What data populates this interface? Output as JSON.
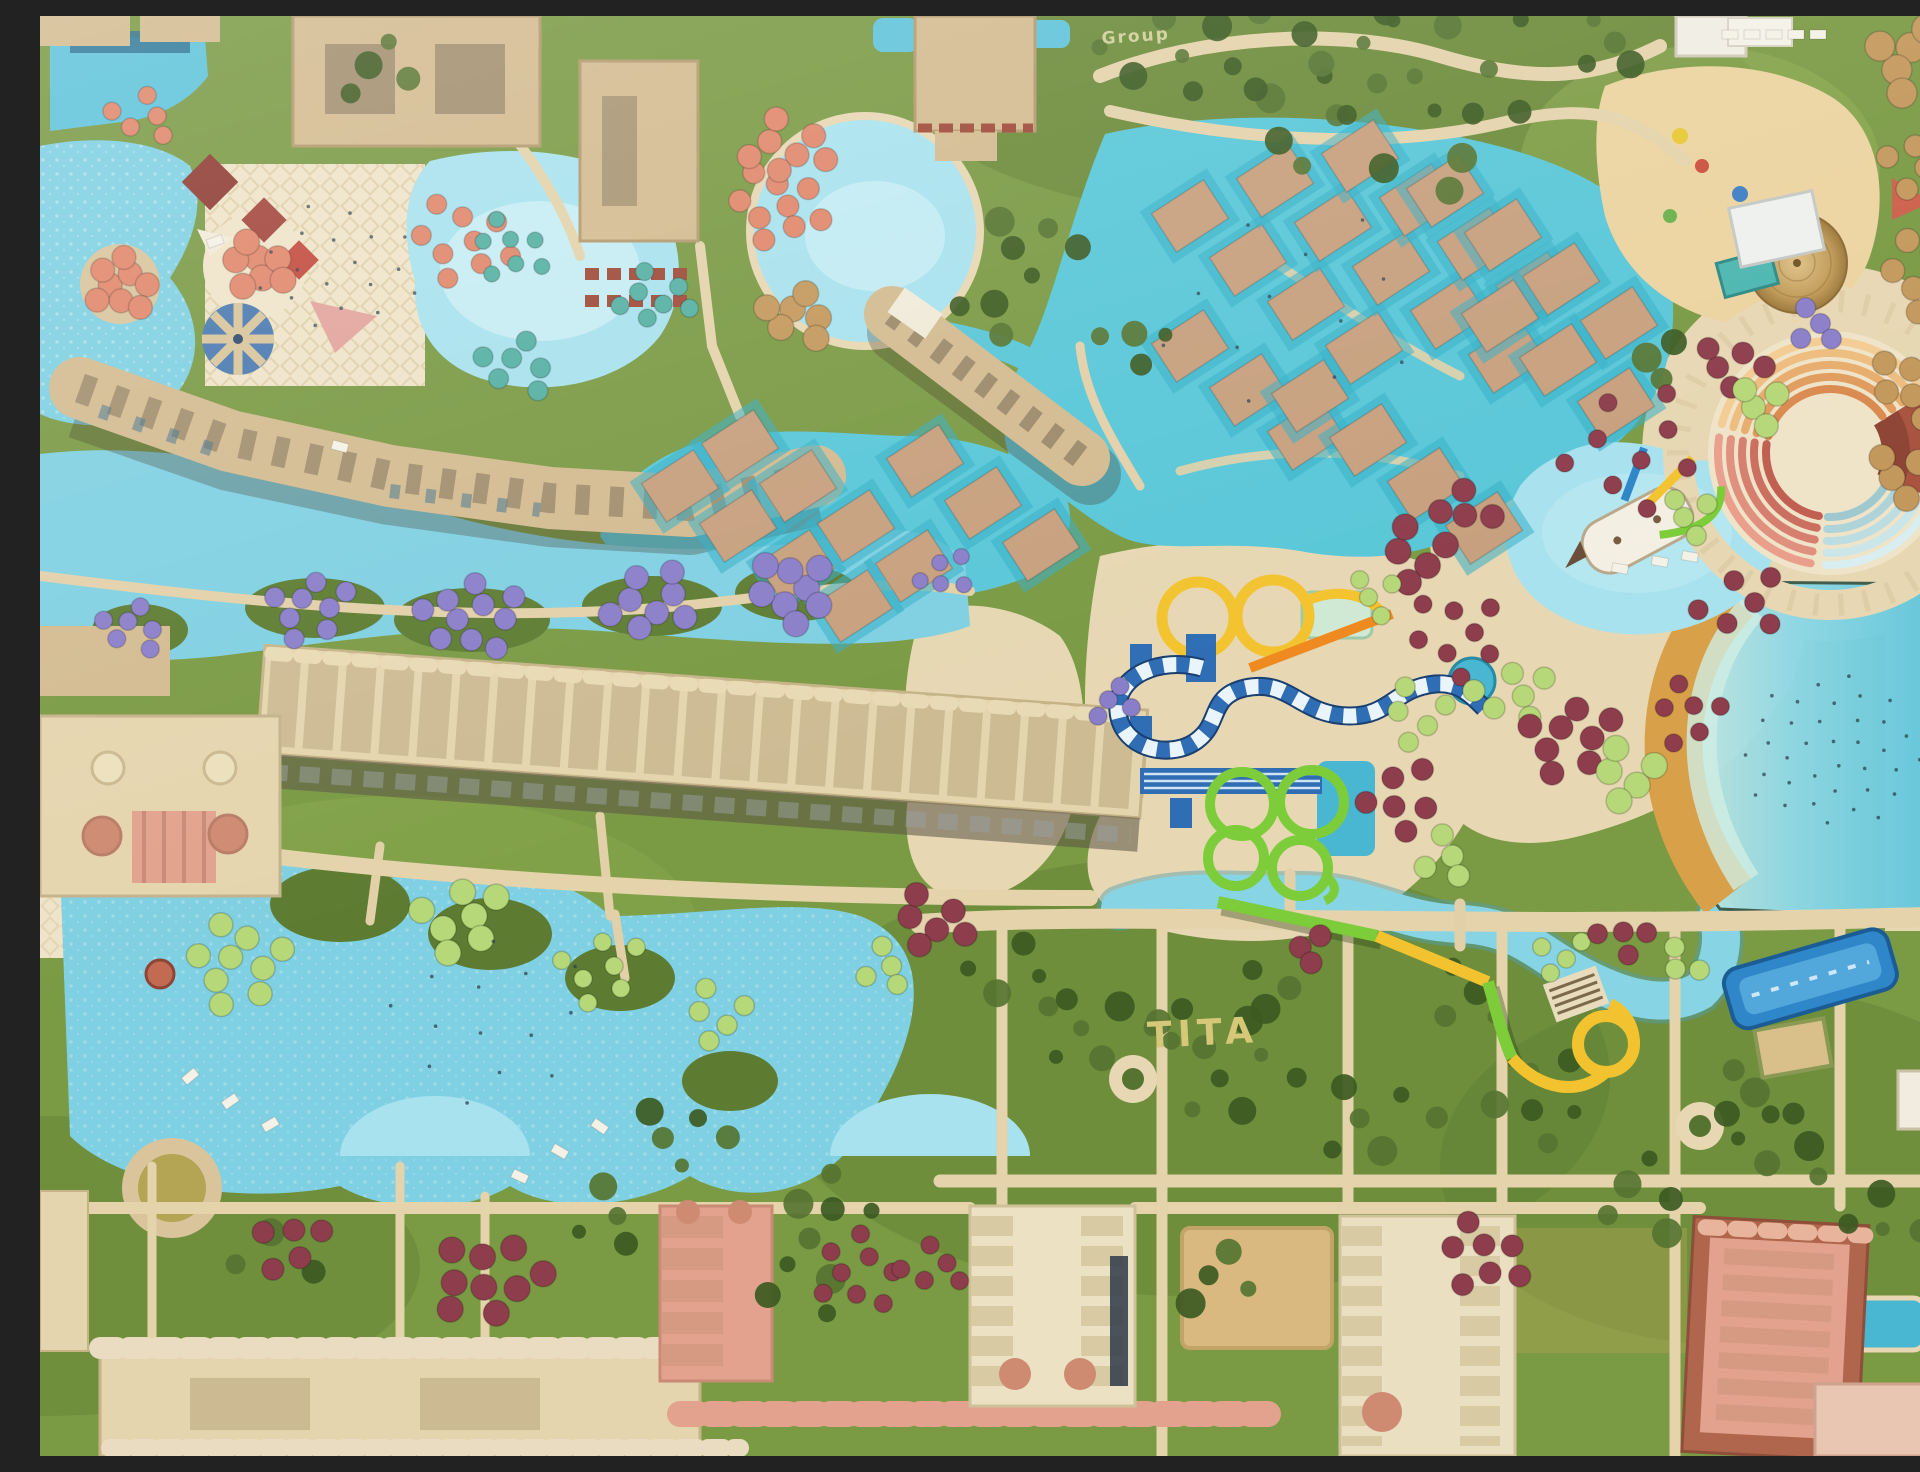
{
  "scene": {
    "type": "aerial-drone-photo",
    "subject": "waterpark resort complex with pools, water slides, gardens and hotel buildings",
    "plant_text_main": "TITA",
    "plant_text_secondary": "Group"
  },
  "palette": {
    "grass": "#7a9a44",
    "grassDark": "#5d7c31",
    "grassLight": "#8fae51",
    "foliage": "#3c5a22",
    "foliageLight": "#567431",
    "deck": "#e7d7b3",
    "deckLight": "#efe4c8",
    "deckShade": "#d9c49c",
    "path": "#e4d3ab",
    "waterLight": "#a8e2ee",
    "water": "#7fd0e2",
    "waterMid": "#5fc3da",
    "waterDeep": "#49b7d2",
    "waterTeal": "#59c7d8",
    "waterPale": "#c2ecf2",
    "roofTan": "#d3bb90",
    "roofTanDark": "#c4a97c",
    "roofCream": "#e5d5ae",
    "roofSalmon": "#e2a28d",
    "roofSalmonDeep": "#cf8a72",
    "roofBrown": "#b0664c",
    "roofWhite": "#f0ead8",
    "roofMaroon": "#8e3b33",
    "windowDark": "#4a4033",
    "shadow": "rgba(60,50,30,0.3)",
    "sand": "#d8a049",
    "sandLight": "#ecd4a0",
    "sandOlive": "#b3a553",
    "cabanaRoof": "#c7a07e",
    "cabanaPad": "#35aec6",
    "umbPurple": "#8a7ec9",
    "umbMaroon": "#8e3d4c",
    "umbLime": "#b6d878",
    "umbTeal": "#55b0a2",
    "umbCoral": "#e0876a",
    "umbStraw": "#c3985c",
    "slideYellow": "#f3c32f",
    "slideOrange": "#ee8a1f",
    "slideBlue": "#2f6db5",
    "slideBlueDark": "#1a3f70",
    "slideGreen": "#7ccd39",
    "slideSky": "#2f86c8",
    "stage": "#a85441",
    "stageInner": "#8e4536",
    "plantText": "#d6c878",
    "plantTextSmall": "#cfcf9a",
    "speck": "#2f4250"
  },
  "amphitheater": {
    "cx": 1790,
    "cy": 437,
    "walk_r": 152,
    "walk_w": 30,
    "plaza_r": 52,
    "radii": [
      64,
      76,
      88,
      100,
      112
    ],
    "sectors": [
      {
        "from": 195,
        "to": 325,
        "ramp": "warm"
      },
      {
        "from": 100,
        "to": 188,
        "ramp": "red"
      },
      {
        "from": 30,
        "to": 92,
        "ramp": "cool"
      }
    ],
    "ramps": {
      "warm": [
        "#d98a4f",
        "#e09c5d",
        "#e7ad6c",
        "#eebd7e",
        "#f3cc92"
      ],
      "red": [
        "#c05f52",
        "#cb6f60",
        "#d67f6f",
        "#e0907e",
        "#ea9f8d"
      ],
      "cool": [
        "#9fc8cf",
        "#aed3d8",
        "#bcdde1",
        "#cae6e9",
        "#d8eef0"
      ]
    },
    "stage_wedge": {
      "from": -32,
      "to": 24,
      "r1": 42,
      "r2": 128
    }
  },
  "cabana_style": {
    "w": 62,
    "h": 46,
    "angle": -33
  },
  "cabana_chains": [
    {
      "x": 1150,
      "y": 200,
      "dx": 58,
      "dy": 44,
      "count": 4
    },
    {
      "x": 1235,
      "y": 165,
      "dx": 58,
      "dy": 44,
      "count": 5
    },
    {
      "x": 1320,
      "y": 140,
      "dx": 58,
      "dy": 44,
      "count": 4
    },
    {
      "x": 1405,
      "y": 175,
      "dx": 58,
      "dy": 44,
      "count": 4
    },
    {
      "x": 1150,
      "y": 330,
      "dx": 58,
      "dy": 44,
      "count": 3
    },
    {
      "x": 1460,
      "y": 300,
      "dx": 58,
      "dy": 44,
      "count": 3
    },
    {
      "x": 1270,
      "y": 380,
      "dx": 58,
      "dy": 44,
      "count": 4
    },
    {
      "x": 640,
      "y": 470,
      "dx": 58,
      "dy": 40,
      "count": 4
    },
    {
      "x": 700,
      "y": 430,
      "dx": 58,
      "dy": 40,
      "count": 4
    },
    {
      "x": 885,
      "y": 445,
      "dx": 58,
      "dy": 42,
      "count": 3
    }
  ],
  "umbrella_clusters": [
    {
      "x": 95,
      "y": 612,
      "count": 6,
      "spread": 34,
      "r": 11,
      "color": "umbPurple"
    },
    {
      "x": 270,
      "y": 590,
      "count": 8,
      "spread": 44,
      "r": 11,
      "color": "umbPurple"
    },
    {
      "x": 430,
      "y": 602,
      "count": 10,
      "spread": 52,
      "r": 11,
      "color": "umbPurple"
    },
    {
      "x": 610,
      "y": 588,
      "count": 8,
      "spread": 46,
      "r": 11,
      "color": "umbPurple"
    },
    {
      "x": 755,
      "y": 575,
      "count": 8,
      "spread": 44,
      "r": 11,
      "color": "umbPurple"
    },
    {
      "x": 905,
      "y": 560,
      "count": 5,
      "spread": 30,
      "r": 10,
      "color": "umbPurple"
    },
    {
      "x": 1075,
      "y": 690,
      "count": 4,
      "spread": 26,
      "r": 10,
      "color": "umbPurple"
    },
    {
      "x": 1770,
      "y": 310,
      "count": 4,
      "spread": 28,
      "r": 10,
      "color": "umbPurple"
    },
    {
      "x": 80,
      "y": 268,
      "count": 8,
      "spread": 36,
      "r": 11,
      "color": "umbCoral"
    },
    {
      "x": 215,
      "y": 250,
      "count": 7,
      "spread": 34,
      "r": 11,
      "color": "umbCoral"
    },
    {
      "x": 105,
      "y": 100,
      "count": 5,
      "spread": 35,
      "r": 11,
      "color": "umbCoral"
    },
    {
      "x": 420,
      "y": 225,
      "count": 9,
      "spread": 55,
      "r": 11,
      "color": "umbCoral"
    },
    {
      "x": 735,
      "y": 190,
      "count": 9,
      "spread": 50,
      "r": 11,
      "color": "umbCoral"
    },
    {
      "x": 750,
      "y": 130,
      "count": 7,
      "spread": 44,
      "r": 11,
      "color": "umbCoral"
    },
    {
      "x": 760,
      "y": 300,
      "count": 6,
      "spread": 36,
      "r": 11,
      "color": "umbStraw"
    },
    {
      "x": 467,
      "y": 233,
      "count": 7,
      "spread": 42,
      "r": 10,
      "color": "umbTeal"
    },
    {
      "x": 617,
      "y": 280,
      "count": 7,
      "spread": 40,
      "r": 10,
      "color": "umbTeal"
    },
    {
      "x": 480,
      "y": 350,
      "count": 6,
      "spread": 40,
      "r": 10,
      "color": "umbTeal"
    },
    {
      "x": 200,
      "y": 950,
      "count": 9,
      "spread": 55,
      "r": 11,
      "color": "umbLime"
    },
    {
      "x": 420,
      "y": 900,
      "count": 7,
      "spread": 48,
      "r": 11,
      "color": "umbLime"
    },
    {
      "x": 560,
      "y": 950,
      "count": 7,
      "spread": 48,
      "r": 11,
      "color": "umbLime"
    },
    {
      "x": 680,
      "y": 1000,
      "count": 5,
      "spread": 38,
      "r": 11,
      "color": "umbLime"
    },
    {
      "x": 840,
      "y": 950,
      "count": 4,
      "spread": 30,
      "r": 10,
      "color": "umbLime"
    },
    {
      "x": 890,
      "y": 905,
      "count": 6,
      "spread": 40,
      "r": 11,
      "color": "umbMaroon"
    },
    {
      "x": 1380,
      "y": 540,
      "count": 5,
      "spread": 40,
      "r": 11,
      "color": "umbMaroon"
    },
    {
      "x": 1420,
      "y": 620,
      "count": 8,
      "spread": 55,
      "r": 11,
      "color": "umbMaroon"
    },
    {
      "x": 1340,
      "y": 580,
      "count": 4,
      "spread": 30,
      "r": 10,
      "color": "umbLime"
    },
    {
      "x": 1470,
      "y": 680,
      "count": 6,
      "spread": 42,
      "r": 11,
      "color": "umbLime"
    },
    {
      "x": 1530,
      "y": 720,
      "count": 8,
      "spread": 50,
      "r": 11,
      "color": "umbMaroon"
    },
    {
      "x": 1590,
      "y": 760,
      "count": 5,
      "spread": 38,
      "r": 11,
      "color": "umbLime"
    },
    {
      "x": 1650,
      "y": 700,
      "count": 6,
      "spread": 42,
      "r": 11,
      "color": "umbMaroon"
    },
    {
      "x": 1380,
      "y": 700,
      "count": 5,
      "spread": 40,
      "r": 11,
      "color": "umbLime"
    },
    {
      "x": 1360,
      "y": 780,
      "count": 6,
      "spread": 45,
      "r": 11,
      "color": "umbMaroon"
    },
    {
      "x": 1400,
      "y": 840,
      "count": 4,
      "spread": 32,
      "r": 10,
      "color": "umbLime"
    },
    {
      "x": 1430,
      "y": 490,
      "count": 4,
      "spread": 32,
      "r": 10,
      "color": "umbMaroon"
    },
    {
      "x": 1590,
      "y": 430,
      "count": 9,
      "spread": 80,
      "r": 11,
      "color": "umbMaroon"
    },
    {
      "x": 1700,
      "y": 590,
      "count": 6,
      "spread": 48,
      "r": 11,
      "color": "umbMaroon"
    },
    {
      "x": 1655,
      "y": 500,
      "count": 4,
      "spread": 30,
      "r": 10,
      "color": "umbLime"
    },
    {
      "x": 1690,
      "y": 350,
      "count": 5,
      "spread": 36,
      "r": 10,
      "color": "umbMaroon"
    },
    {
      "x": 1725,
      "y": 390,
      "count": 4,
      "spread": 30,
      "r": 10,
      "color": "umbLime"
    },
    {
      "x": 1520,
      "y": 935,
      "count": 4,
      "spread": 30,
      "r": 11,
      "color": "umbLime"
    },
    {
      "x": 1580,
      "y": 925,
      "count": 4,
      "spread": 30,
      "r": 11,
      "color": "umbMaroon"
    },
    {
      "x": 1640,
      "y": 945,
      "count": 3,
      "spread": 24,
      "r": 10,
      "color": "umbLime"
    },
    {
      "x": 1270,
      "y": 930,
      "count": 3,
      "spread": 22,
      "r": 10,
      "color": "umbMaroon"
    },
    {
      "x": 450,
      "y": 1260,
      "count": 9,
      "spread": 58,
      "r": 11,
      "color": "umbMaroon"
    },
    {
      "x": 815,
      "y": 1255,
      "count": 8,
      "spread": 50,
      "r": 11,
      "color": "umbMaroon"
    },
    {
      "x": 895,
      "y": 1250,
      "count": 5,
      "spread": 36,
      "r": 10,
      "color": "umbMaroon"
    },
    {
      "x": 1440,
      "y": 1240,
      "count": 7,
      "spread": 48,
      "r": 11,
      "color": "umbMaroon"
    },
    {
      "x": 250,
      "y": 1225,
      "count": 5,
      "spread": 40,
      "r": 10,
      "color": "umbMaroon"
    },
    {
      "x": 1880,
      "y": 40,
      "count": 8,
      "spread": 50,
      "r": 13,
      "color": "umbStraw"
    },
    {
      "x": 1900,
      "y": 150,
      "count": 9,
      "spread": 55,
      "r": 13,
      "color": "umbStraw"
    },
    {
      "x": 1890,
      "y": 260,
      "count": 8,
      "spread": 50,
      "r": 13,
      "color": "umbStraw"
    },
    {
      "x": 1878,
      "y": 370,
      "count": 7,
      "spread": 45,
      "r": 12,
      "color": "umbStraw"
    },
    {
      "x": 1865,
      "y": 460,
      "count": 5,
      "spread": 38,
      "r": 12,
      "color": "umbStraw"
    }
  ],
  "tree_clusters": [
    {
      "x": 1120,
      "y": 40,
      "count": 6,
      "spread": 70
    },
    {
      "x": 1260,
      "y": 60,
      "count": 8,
      "spread": 90
    },
    {
      "x": 1420,
      "y": 60,
      "count": 8,
      "spread": 110
    },
    {
      "x": 1340,
      "y": 95,
      "count": 9,
      "spread": 130
    },
    {
      "x": 1560,
      "y": 30,
      "count": 4,
      "spread": 40
    },
    {
      "x": 990,
      "y": 230,
      "count": 5,
      "spread": 50
    },
    {
      "x": 1090,
      "y": 330,
      "count": 4,
      "spread": 40
    },
    {
      "x": 340,
      "y": 60,
      "count": 4,
      "spread": 45
    },
    {
      "x": 1620,
      "y": 340,
      "count": 3,
      "spread": 30
    },
    {
      "x": 980,
      "y": 960,
      "count": 5,
      "spread": 55
    },
    {
      "x": 1060,
      "y": 1010,
      "count": 6,
      "spread": 60
    },
    {
      "x": 1200,
      "y": 1060,
      "count": 7,
      "spread": 70
    },
    {
      "x": 1340,
      "y": 1100,
      "count": 6,
      "spread": 65
    },
    {
      "x": 1500,
      "y": 1080,
      "count": 6,
      "spread": 60
    },
    {
      "x": 1240,
      "y": 960,
      "count": 4,
      "spread": 45
    },
    {
      "x": 1420,
      "y": 980,
      "count": 4,
      "spread": 45
    },
    {
      "x": 1600,
      "y": 1180,
      "count": 5,
      "spread": 55
    },
    {
      "x": 1750,
      "y": 1130,
      "count": 5,
      "spread": 55
    },
    {
      "x": 1850,
      "y": 1200,
      "count": 4,
      "spread": 45
    },
    {
      "x": 760,
      "y": 1260,
      "count": 5,
      "spread": 55
    },
    {
      "x": 560,
      "y": 1200,
      "count": 4,
      "spread": 45
    },
    {
      "x": 1180,
      "y": 1270,
      "count": 4,
      "spread": 45
    },
    {
      "x": 640,
      "y": 1120,
      "count": 5,
      "spread": 50
    },
    {
      "x": 800,
      "y": 1180,
      "count": 4,
      "spread": 45
    },
    {
      "x": 1130,
      "y": 1005,
      "count": 3,
      "spread": 26
    },
    {
      "x": 950,
      "y": 300,
      "count": 3,
      "spread": 35
    },
    {
      "x": 1700,
      "y": 1080,
      "count": 4,
      "spread": 40
    },
    {
      "x": 240,
      "y": 1240,
      "count": 4,
      "spread": 48
    }
  ],
  "lounger_pads": [
    {
      "x": 150,
      "y": 1060,
      "rot": -40
    },
    {
      "x": 190,
      "y": 1085,
      "rot": -35
    },
    {
      "x": 230,
      "y": 1108,
      "rot": -30
    },
    {
      "x": 480,
      "y": 1160,
      "rot": 25
    },
    {
      "x": 520,
      "y": 1135,
      "rot": 30
    },
    {
      "x": 560,
      "y": 1110,
      "rot": 35
    },
    {
      "x": 1690,
      "y": 18,
      "rot": 0
    },
    {
      "x": 1712,
      "y": 18,
      "rot": 0
    },
    {
      "x": 1734,
      "y": 18,
      "rot": 0
    },
    {
      "x": 1756,
      "y": 18,
      "rot": 0
    },
    {
      "x": 1778,
      "y": 18,
      "rot": 0
    },
    {
      "x": 1620,
      "y": 545,
      "rot": 10
    },
    {
      "x": 1650,
      "y": 540,
      "rot": 10
    },
    {
      "x": 1580,
      "y": 552,
      "rot": 10
    },
    {
      "x": 175,
      "y": 225,
      "rot": -20
    },
    {
      "x": 300,
      "y": 430,
      "rot": 15
    }
  ],
  "people_specks": [
    {
      "x": 1790,
      "y": 735,
      "count": 36,
      "spread": 95
    },
    {
      "x": 300,
      "y": 250,
      "count": 18,
      "spread": 85
    },
    {
      "x": 450,
      "y": 1000,
      "count": 14,
      "spread": 110
    },
    {
      "x": 1250,
      "y": 300,
      "count": 12,
      "spread": 140
    }
  ]
}
